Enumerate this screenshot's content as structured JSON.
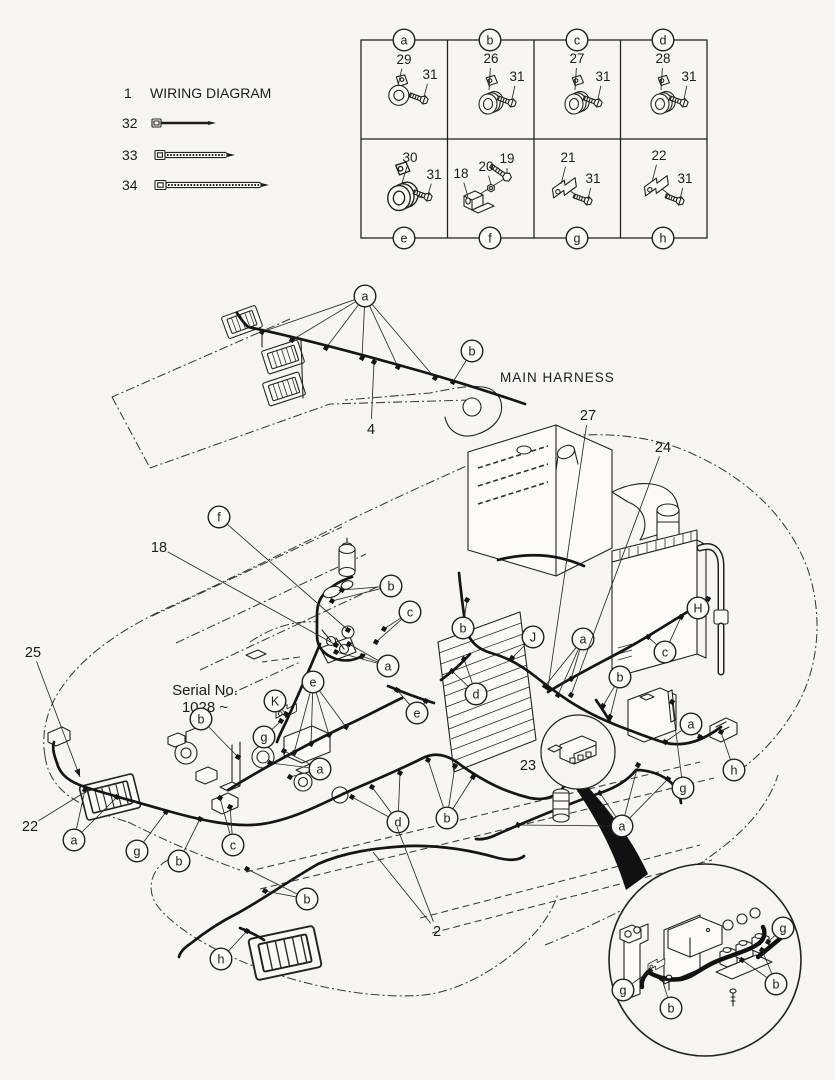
{
  "colors": {
    "ink": "#1c1c1c",
    "paper": "#f6f5f1"
  },
  "legend": {
    "item_number": "1",
    "title": "WIRING DIAGRAM",
    "ties": [
      {
        "number": "32"
      },
      {
        "number": "33"
      },
      {
        "number": "34"
      }
    ]
  },
  "parts_table": {
    "cells": [
      {
        "letter": "a",
        "cx": 404,
        "cy": 40
      },
      {
        "letter": "b",
        "cx": 490,
        "cy": 40
      },
      {
        "letter": "c",
        "cx": 577,
        "cy": 40
      },
      {
        "letter": "d",
        "cx": 663,
        "cy": 40
      },
      {
        "letter": "e",
        "cx": 404,
        "cy": 238
      },
      {
        "letter": "f",
        "cx": 490,
        "cy": 238
      },
      {
        "letter": "g",
        "cx": 577,
        "cy": 238
      },
      {
        "letter": "h",
        "cx": 663,
        "cy": 238
      }
    ],
    "part_labels": [
      {
        "t": "29",
        "x": 404,
        "y": 64,
        "l": [
          [
            398,
            86
          ]
        ],
        "s": 13.5
      },
      {
        "t": "31",
        "x": 430,
        "y": 79,
        "l": [
          [
            424,
            97
          ]
        ],
        "s": 13.5
      },
      {
        "t": "26",
        "x": 491,
        "y": 63,
        "l": [
          [
            489,
            90
          ]
        ],
        "s": 13.5
      },
      {
        "t": "31",
        "x": 517,
        "y": 81,
        "l": [
          [
            512,
            99
          ]
        ],
        "s": 13.5
      },
      {
        "t": "27",
        "x": 577,
        "y": 63,
        "l": [
          [
            575,
            90
          ]
        ],
        "s": 13.5
      },
      {
        "t": "31",
        "x": 603,
        "y": 81,
        "l": [
          [
            598,
            99
          ]
        ],
        "s": 13.5
      },
      {
        "t": "28",
        "x": 663,
        "y": 63,
        "l": [
          [
            661,
            90
          ]
        ],
        "s": 13.5
      },
      {
        "t": "31",
        "x": 689,
        "y": 81,
        "l": [
          [
            684,
            99
          ]
        ],
        "s": 13.5
      },
      {
        "t": "30",
        "x": 410,
        "y": 162,
        "l": [
          [
            402,
            183
          ]
        ],
        "s": 13.5
      },
      {
        "t": "31",
        "x": 434,
        "y": 179,
        "l": [
          [
            428,
            195
          ]
        ],
        "s": 13.5
      },
      {
        "t": "18",
        "x": 461,
        "y": 178,
        "l": [
          [
            468,
            197
          ]
        ],
        "s": 13.5
      },
      {
        "t": "20",
        "x": 486,
        "y": 171,
        "l": [
          [
            491,
            185
          ]
        ],
        "s": 13.5
      },
      {
        "t": "19",
        "x": 507,
        "y": 163,
        "l": [
          [
            507,
            174
          ]
        ],
        "s": 13.5
      },
      {
        "t": "21",
        "x": 568,
        "y": 162,
        "l": [
          [
            561,
            184
          ]
        ],
        "s": 13.5
      },
      {
        "t": "31",
        "x": 593,
        "y": 183,
        "l": [
          [
            588,
            199
          ]
        ],
        "s": 13.5
      },
      {
        "t": "22",
        "x": 659,
        "y": 160,
        "l": [
          [
            652,
            182
          ]
        ],
        "s": 13.5
      },
      {
        "t": "31",
        "x": 685,
        "y": 183,
        "l": [
          [
            680,
            199
          ]
        ],
        "s": 13.5
      }
    ]
  },
  "boom": {
    "harness_label": "MAIN HARNESS"
  },
  "machine": {
    "serial_line1": "Serial No.",
    "serial_line2": "1028 ~"
  },
  "drawing": {
    "callouts": [
      {
        "t": "a",
        "x": 365,
        "y": 296,
        "l": [
          [
            262,
            332
          ],
          [
            292,
            340
          ],
          [
            326,
            348
          ],
          [
            362,
            358
          ],
          [
            398,
            367
          ],
          [
            435,
            378
          ]
        ]
      },
      {
        "t": "b",
        "x": 472,
        "y": 351,
        "l": [
          [
            453,
            382
          ]
        ]
      },
      {
        "t": "f",
        "x": 219,
        "y": 517,
        "l": [
          [
            348,
            630
          ]
        ]
      },
      {
        "t": "b",
        "x": 463,
        "y": 628,
        "l": [
          [
            467,
            600
          ]
        ]
      },
      {
        "t": "J",
        "x": 533,
        "y": 637,
        "l": [
          [
            512,
            658
          ]
        ]
      },
      {
        "t": "a",
        "x": 583,
        "y": 639,
        "l": [
          [
            545,
            686
          ],
          [
            558,
            695
          ],
          [
            571,
            679
          ]
        ]
      },
      {
        "t": "H",
        "x": 698,
        "y": 608,
        "l": [
          [
            708,
            599
          ]
        ]
      },
      {
        "t": "c",
        "x": 665,
        "y": 652,
        "l": [
          [
            648,
            637
          ],
          [
            681,
            617
          ]
        ]
      },
      {
        "t": "b",
        "x": 620,
        "y": 677,
        "l": [
          [
            603,
            706
          ],
          [
            610,
            717
          ]
        ]
      },
      {
        "t": "b",
        "x": 391,
        "y": 586,
        "l": [
          [
            342,
            590
          ],
          [
            332,
            601
          ]
        ]
      },
      {
        "t": "c",
        "x": 410,
        "y": 612,
        "l": [
          [
            384,
            629
          ],
          [
            376,
            642
          ]
        ]
      },
      {
        "t": "a",
        "x": 388,
        "y": 666,
        "l": [
          [
            362,
            656
          ],
          [
            349,
            644
          ],
          [
            336,
            652
          ]
        ]
      },
      {
        "t": "e",
        "x": 313,
        "y": 682,
        "l": [
          [
            294,
            753
          ],
          [
            311,
            744
          ],
          [
            329,
            735
          ],
          [
            346,
            727
          ]
        ]
      },
      {
        "t": "e",
        "x": 417,
        "y": 713,
        "l": [
          [
            397,
            690
          ],
          [
            426,
            701
          ]
        ]
      },
      {
        "t": "d",
        "x": 476,
        "y": 694,
        "l": [
          [
            452,
            671
          ],
          [
            464,
            659
          ]
        ]
      },
      {
        "t": "K",
        "x": 275,
        "y": 701,
        "l": [
          [
            286,
            714
          ]
        ]
      },
      {
        "t": "b",
        "x": 201,
        "y": 719,
        "l": [
          [
            238,
            757
          ]
        ]
      },
      {
        "t": "g",
        "x": 264,
        "y": 737,
        "l": [
          [
            281,
            721
          ]
        ]
      },
      {
        "t": "a",
        "x": 74,
        "y": 840,
        "l": [
          [
            85,
            790
          ],
          [
            117,
            797
          ]
        ]
      },
      {
        "t": "g",
        "x": 137,
        "y": 851,
        "l": [
          [
            166,
            812
          ]
        ]
      },
      {
        "t": "b",
        "x": 179,
        "y": 861,
        "l": [
          [
            200,
            819
          ]
        ]
      },
      {
        "t": "c",
        "x": 233,
        "y": 845,
        "l": [
          [
            220,
            798
          ],
          [
            230,
            807
          ]
        ]
      },
      {
        "t": "a",
        "x": 320,
        "y": 769,
        "l": [
          [
            284,
            751
          ],
          [
            270,
            763
          ],
          [
            290,
            777
          ]
        ]
      },
      {
        "t": "d",
        "x": 398,
        "y": 822,
        "l": [
          [
            352,
            797
          ],
          [
            372,
            787
          ],
          [
            400,
            773
          ]
        ]
      },
      {
        "t": "b",
        "x": 447,
        "y": 818,
        "l": [
          [
            428,
            760
          ],
          [
            455,
            766
          ],
          [
            473,
            777
          ]
        ]
      },
      {
        "t": "b",
        "x": 307,
        "y": 899,
        "l": [
          [
            265,
            891
          ],
          [
            247,
            869
          ]
        ]
      },
      {
        "t": "h",
        "x": 221,
        "y": 959,
        "l": [
          [
            247,
            931
          ]
        ]
      },
      {
        "t": "a",
        "x": 622,
        "y": 826,
        "l": [
          [
            518,
            825
          ],
          [
            600,
            793
          ],
          [
            638,
            765
          ],
          [
            668,
            779
          ]
        ]
      },
      {
        "t": "a",
        "x": 691,
        "y": 724,
        "l": [
          [
            665,
            742
          ],
          [
            700,
            737
          ]
        ]
      },
      {
        "t": "h",
        "x": 734,
        "y": 770,
        "l": [
          [
            721,
            732
          ]
        ]
      },
      {
        "t": "g",
        "x": 683,
        "y": 788,
        "l": [
          [
            672,
            702
          ]
        ]
      },
      {
        "t": "g",
        "x": 623,
        "y": 990,
        "l": [
          [
            650,
            971
          ]
        ]
      },
      {
        "t": "b",
        "x": 671,
        "y": 1008,
        "l": [
          [
            662,
            979
          ]
        ]
      },
      {
        "t": "b",
        "x": 776,
        "y": 984,
        "l": [
          [
            762,
            950
          ],
          [
            742,
            960
          ]
        ]
      },
      {
        "t": "g",
        "x": 783,
        "y": 928,
        "l": [
          [
            768,
            942
          ]
        ]
      }
    ],
    "labels": [
      {
        "t": "27",
        "x": 588,
        "y": 420,
        "l": [
          [
            548,
            688
          ]
        ],
        "sq": true
      },
      {
        "t": "24",
        "x": 663,
        "y": 452,
        "l": [
          [
            571,
            695
          ]
        ],
        "sq": true
      },
      {
        "t": "18",
        "x": 159,
        "y": 552,
        "l": [
          [
            336,
            645
          ]
        ],
        "sq": true
      },
      {
        "t": "25",
        "x": 33,
        "y": 657,
        "l": [
          [
            80,
            777
          ]
        ],
        "arrow": true
      },
      {
        "t": "22",
        "x": 30,
        "y": 831,
        "l": [
          [
            90,
            789
          ]
        ]
      },
      {
        "t": "23",
        "x": 528,
        "y": 770,
        "l": []
      },
      {
        "t": "2",
        "x": 437,
        "y": 936,
        "l": [
          [
            397,
            827
          ],
          [
            373,
            852
          ]
        ]
      },
      {
        "t": "4",
        "x": 371,
        "y": 434,
        "l": [
          [
            374,
            362
          ]
        ],
        "sq": true
      }
    ]
  }
}
